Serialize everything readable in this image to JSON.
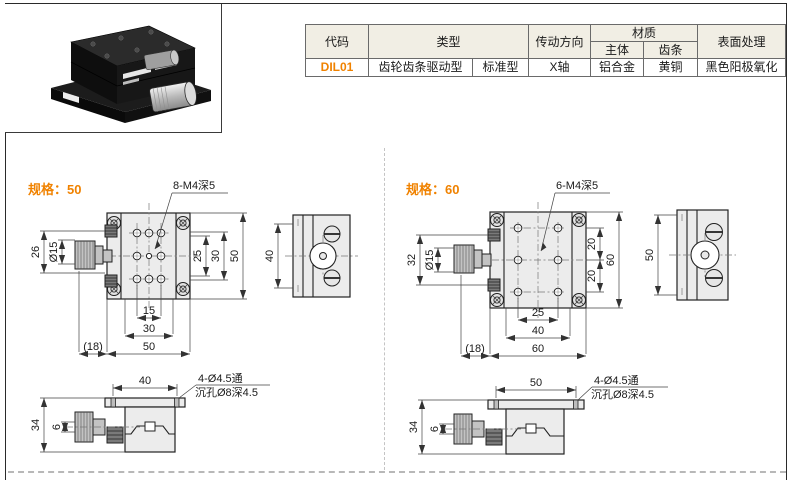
{
  "colors": {
    "accent": "#F08200",
    "table_header_bg": "#F1EEE4",
    "drawing_fill": "#ECECEC"
  },
  "spec_table": {
    "headers": {
      "code": "代码",
      "type": "类型",
      "direction": "传动方向",
      "material": "材质",
      "material_body": "主体",
      "material_rack": "齿条",
      "surface": "表面处理"
    },
    "rows": [
      {
        "code": "DIL01",
        "type_main": "齿轮齿条驱动型",
        "type_sub": "标准型",
        "direction": "X轴",
        "material_body": "铝合金",
        "material_rack": "黄铜",
        "surface": "黑色阳极氧化"
      }
    ]
  },
  "specs": [
    {
      "title": "规格：50",
      "hole_label": "8-M4深5",
      "through_label": "4-Ø4.5通",
      "counterbore_label": "沉孔Ø8深4.5",
      "dims": {
        "knob_len": "26",
        "shaft_dia": "Ø15",
        "v_inner": "25",
        "v_mid": "30",
        "v_outer": "50",
        "h_inner": "15",
        "h_mid": "30",
        "h_outer": "50",
        "overhang": "(18)",
        "side_span": "40",
        "height": "34",
        "shaft_offset": "6",
        "hole_span": "40"
      }
    },
    {
      "title": "规格：60",
      "hole_label": "6-M4深5",
      "through_label": "4-Ø4.5通",
      "counterbore_label": "沉孔Ø8深4.5",
      "dims": {
        "knob_len": "32",
        "shaft_dia": "Ø15",
        "v_top": "20",
        "v_bottom": "20",
        "v_outer": "60",
        "h_inner": "25",
        "h_mid": "40",
        "h_outer": "60",
        "overhang": "(18)",
        "side_span": "50",
        "height": "34",
        "shaft_offset": "6",
        "hole_span": "50"
      }
    }
  ]
}
